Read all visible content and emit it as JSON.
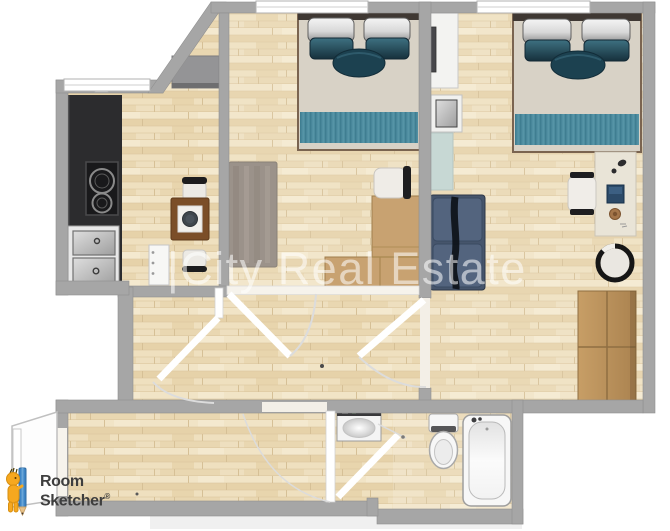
{
  "watermark": {
    "text": "|City Real Estate"
  },
  "branding": {
    "line1": "Room",
    "line2": "Sketcher",
    "registered": "®"
  },
  "palette": {
    "wall_gray": "#a6a6a6",
    "floor_wood": "#ecdcba",
    "counter_black": "#2c2c2e",
    "bed_runner_teal": "#4d8c9f",
    "pillow_teal": "#2b5564",
    "sofa_blue": "#53647e",
    "furniture_wood": "#c79e66",
    "mat_blue": "#c7d8d4",
    "rug_gray": "#9b928a",
    "brand_orange": "#f6a81f",
    "brand_pencil_blue": "#3f86c6",
    "brand_text_gray": "#3e3e3e",
    "watermark_color": "#ffffff"
  },
  "floor_plan": {
    "rooms": [
      "kitchen-dining",
      "bedroom-1",
      "bedroom-2",
      "living-area",
      "hallway",
      "bathroom",
      "entry-nook"
    ],
    "objects": [
      "kitchen-counter",
      "cooktop",
      "double-sink",
      "dining-table",
      "dining-chairs",
      "storage-cabinet",
      "closet-cabinet",
      "area-rug",
      "double-bed-1",
      "double-bed-2",
      "tv-cabinet",
      "side-table",
      "blue-mat",
      "loveseat-sofa",
      "corner-desk",
      "desk-chair-1",
      "writing-desk",
      "desk-chair-2",
      "round-stool",
      "wardrobe",
      "washing-machine",
      "toilet",
      "bathtub",
      "interior-doors",
      "windows",
      "entry-door"
    ]
  }
}
